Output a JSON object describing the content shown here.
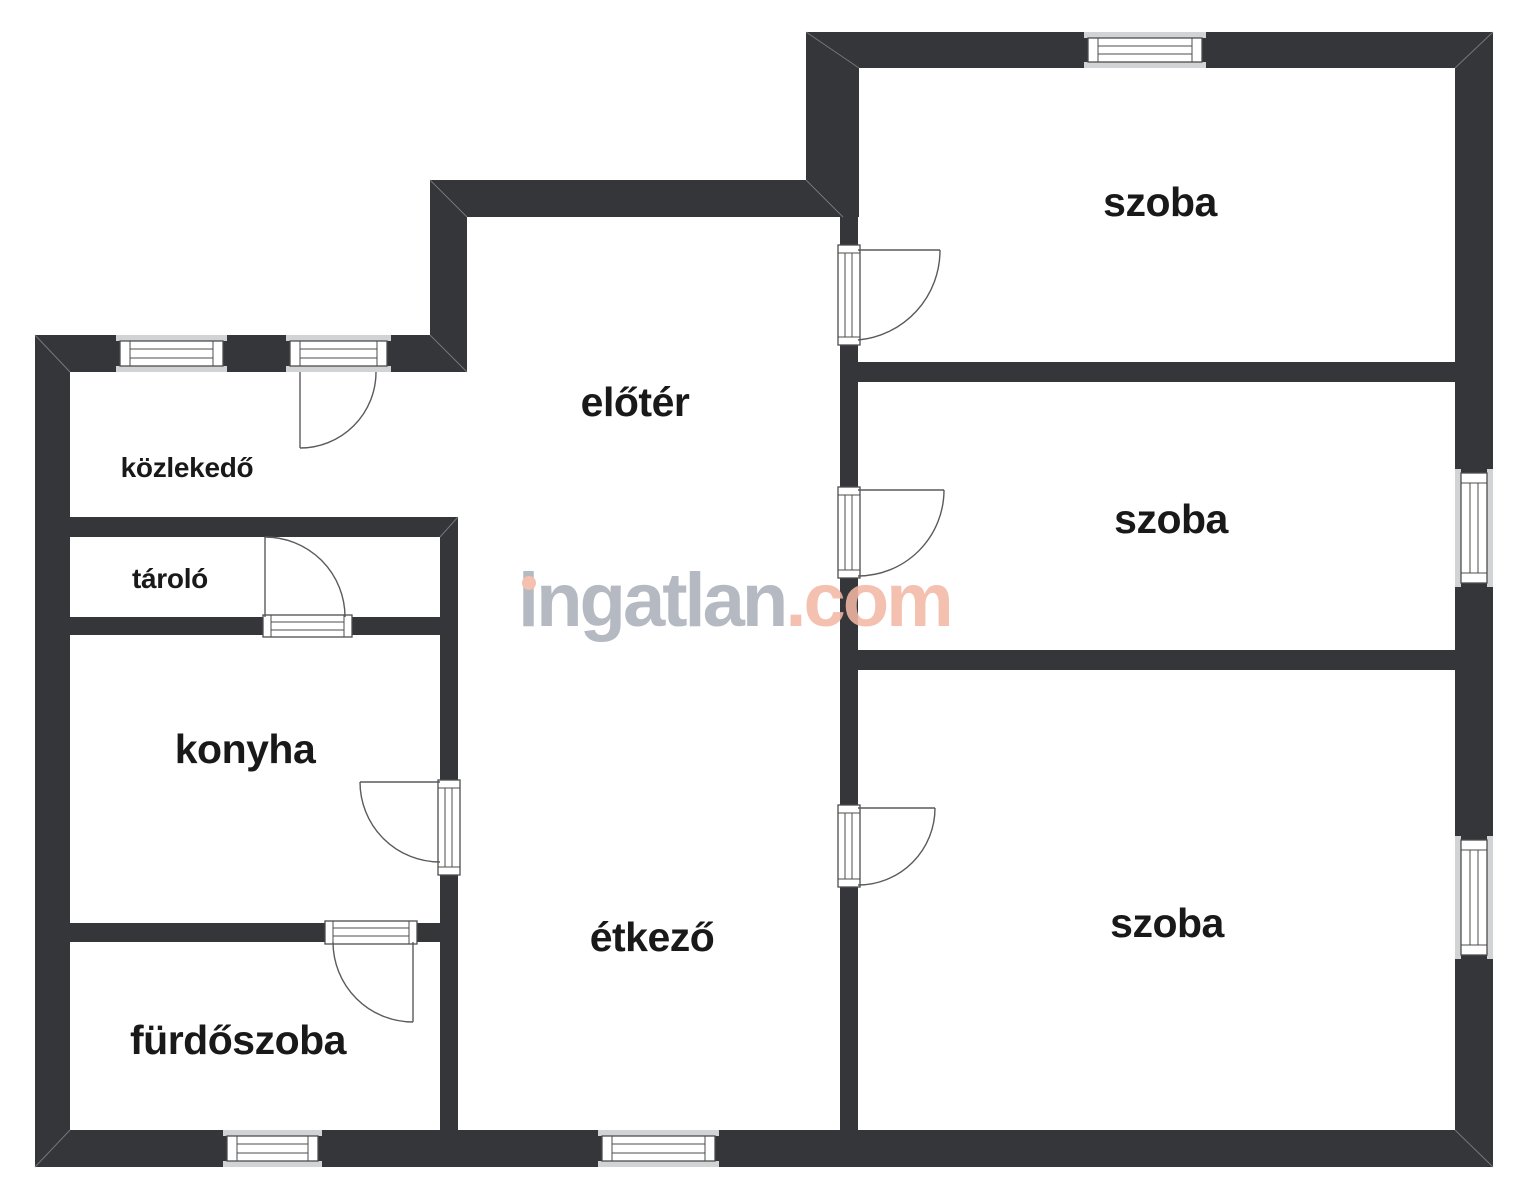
{
  "image_type": "floor-plan",
  "watermark": {
    "brand": "ingatlan",
    "suffix": ".com"
  },
  "rooms": [
    {
      "id": "szoba-1",
      "label": "szoba"
    },
    {
      "id": "szoba-2",
      "label": "szoba"
    },
    {
      "id": "szoba-3",
      "label": "szoba"
    },
    {
      "id": "eloter",
      "label": "előtér"
    },
    {
      "id": "kozlekedo",
      "label": "közlekedő"
    },
    {
      "id": "tarolo",
      "label": "tároló"
    },
    {
      "id": "konyha",
      "label": "konyha"
    },
    {
      "id": "furdoszoba",
      "label": "fürdőszoba"
    },
    {
      "id": "etkezo",
      "label": "étkező"
    }
  ],
  "symbol_counts": {
    "windows": 6,
    "doors": 7
  },
  "colors": {
    "wall": "#35363a",
    "background": "#ffffff",
    "window_sill": "#d2d3d5",
    "watermark_gray": "#a9afba",
    "watermark_salmon": "#f3b7a4",
    "label_text": "#191919"
  }
}
